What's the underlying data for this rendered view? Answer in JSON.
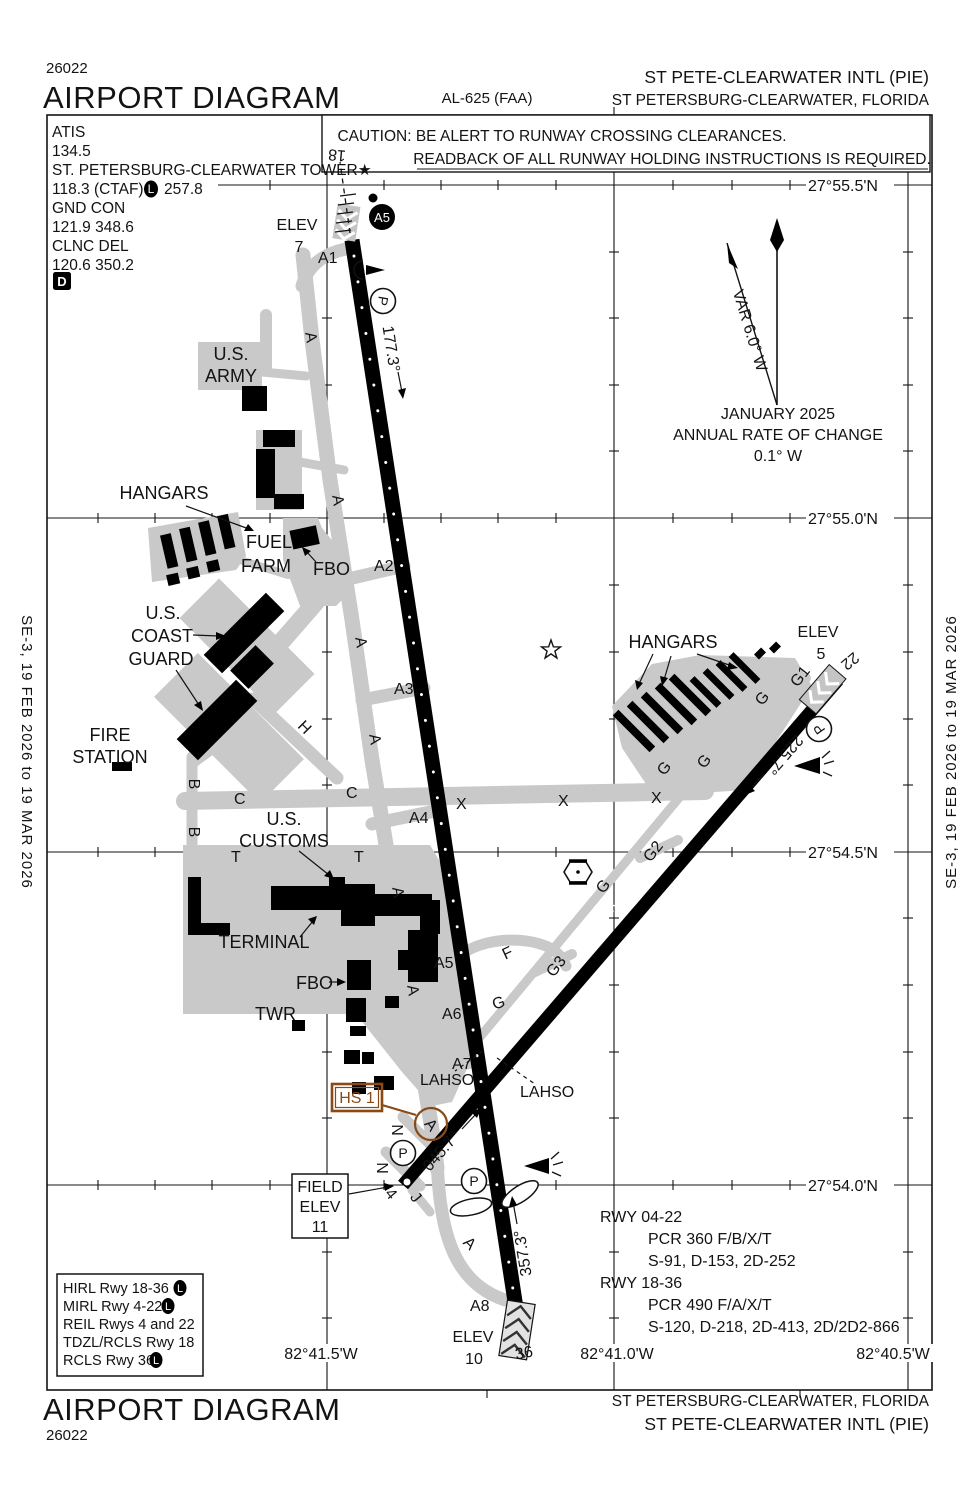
{
  "header": {
    "chart_number": "26022",
    "title": "AIRPORT DIAGRAM",
    "al_number": "AL-625 (FAA)",
    "airport": "ST PETE-CLEARWATER INTL (PIE)",
    "city": "ST PETERSBURG-CLEARWATER, FLORIDA"
  },
  "footer": {
    "title": "AIRPORT DIAGRAM",
    "chart_number": "26022",
    "city": "ST PETERSBURG-CLEARWATER, FLORIDA",
    "airport": "ST PETE-CLEARWATER INTL (PIE)"
  },
  "margin": {
    "left_edition": "SE-3,  19 FEB 2026  to  19 MAR 2026",
    "right_edition": "SE-3,  19 FEB 2026  to  19 MAR 2026"
  },
  "caution": {
    "line1": "CAUTION: BE ALERT TO RUNWAY CROSSING CLEARANCES.",
    "line2": "READBACK OF ALL RUNWAY HOLDING INSTRUCTIONS IS REQUIRED."
  },
  "comms": {
    "atis_label": "ATIS",
    "atis_freq": "134.5",
    "tower_name": "ST. PETERSBURG-CLEARWATER TOWER★",
    "tower_freq_a": "118.3 (CTAF)",
    "l_badge": "L",
    "tower_freq_b": "257.8",
    "gnd_label": "GND CON",
    "gnd_freq": "121.9  348.6",
    "clnc_label": "CLNC DEL",
    "clnc_freq": "120.6  350.2",
    "d_badge": "D"
  },
  "variation": {
    "var": "VAR 6.0° W",
    "date": "JANUARY 2025",
    "rate_line1": "ANNUAL RATE OF CHANGE",
    "rate_line2": "0.1° W"
  },
  "grid": {
    "lat": [
      "27°55.5'N",
      "27°55.0'N",
      "27°54.5'N",
      "27°54.0'N"
    ],
    "lon": [
      "82°41.5'W",
      "82°41.0'W",
      "82°40.5'W"
    ]
  },
  "runway_info": {
    "rwy0422_title": "RWY 04-22",
    "rwy0422_pcr": "PCR 360 F/B/X/T",
    "rwy0422_strength": "S-91, D-153, 2D-252",
    "rwy1836_title": "RWY 18-36",
    "rwy1836_pcr": "PCR 490 F/A/X/T",
    "rwy1836_strength": "S-120, D-218, 2D-413, 2D/2D2-866"
  },
  "lighting": {
    "line1": "HIRL Rwy 18-36",
    "line2": "MIRL Rwy 4-22",
    "line3": "REIL Rwys 4 and 22",
    "line4": "TDZL/RCLS Rwy 18",
    "line5": "RCLS Rwy 36",
    "l_badge": "L"
  },
  "map": {
    "tw": [
      "A1",
      "A2",
      "A3",
      "A4",
      "A5",
      "A6",
      "A7",
      "A8",
      "A",
      "A",
      "A",
      "A",
      "A",
      "A",
      "A",
      "B",
      "B",
      "C",
      "C",
      "H",
      "T",
      "T",
      "X",
      "X",
      "X",
      "F",
      "G",
      "G",
      "G",
      "G",
      "G",
      "G1",
      "G2",
      "G3",
      "N",
      "N",
      "J",
      "4",
      "22",
      "18",
      "36",
      "A"
    ],
    "dim_1836": "9730 X 150",
    "dim_0422": "6000 X 150",
    "hdg18": "177.3°",
    "hdg36": "357.3°",
    "hdg04": "045.7°",
    "hdg22": "225.7°",
    "lahso": "LAHSO",
    "hs1": "HS 1",
    "a5_light": "A5",
    "p": "P",
    "elev18_label": "ELEV",
    "elev18_value": "7",
    "elev22_label": "ELEV",
    "elev22_value": "5",
    "elev36_label": "ELEV",
    "elev36_value": "10",
    "field_elev_line1": "FIELD",
    "field_elev_line2": "ELEV",
    "field_elev_line3": "11",
    "us_army_line1": "U.S.",
    "us_army_line2": "ARMY",
    "hangars_west": "HANGARS",
    "fuel_line1": "FUEL",
    "fuel_line2": "FARM",
    "fbo_north": "FBO",
    "uscg_line1": "U.S.",
    "uscg_line2": "COAST",
    "uscg_line3": "GUARD",
    "fire_line1": "FIRE",
    "fire_line2": "STATION",
    "customs_line1": "U.S.",
    "customs_line2": "CUSTOMS",
    "terminal": "TERMINAL",
    "fbo_south": "FBO",
    "twr": "TWR",
    "hangars_ne": "HANGARS"
  },
  "colors": {
    "hotspot_brown": "#8a4a15",
    "apron_gray": "#c9c9c9",
    "ink": "#131313"
  }
}
